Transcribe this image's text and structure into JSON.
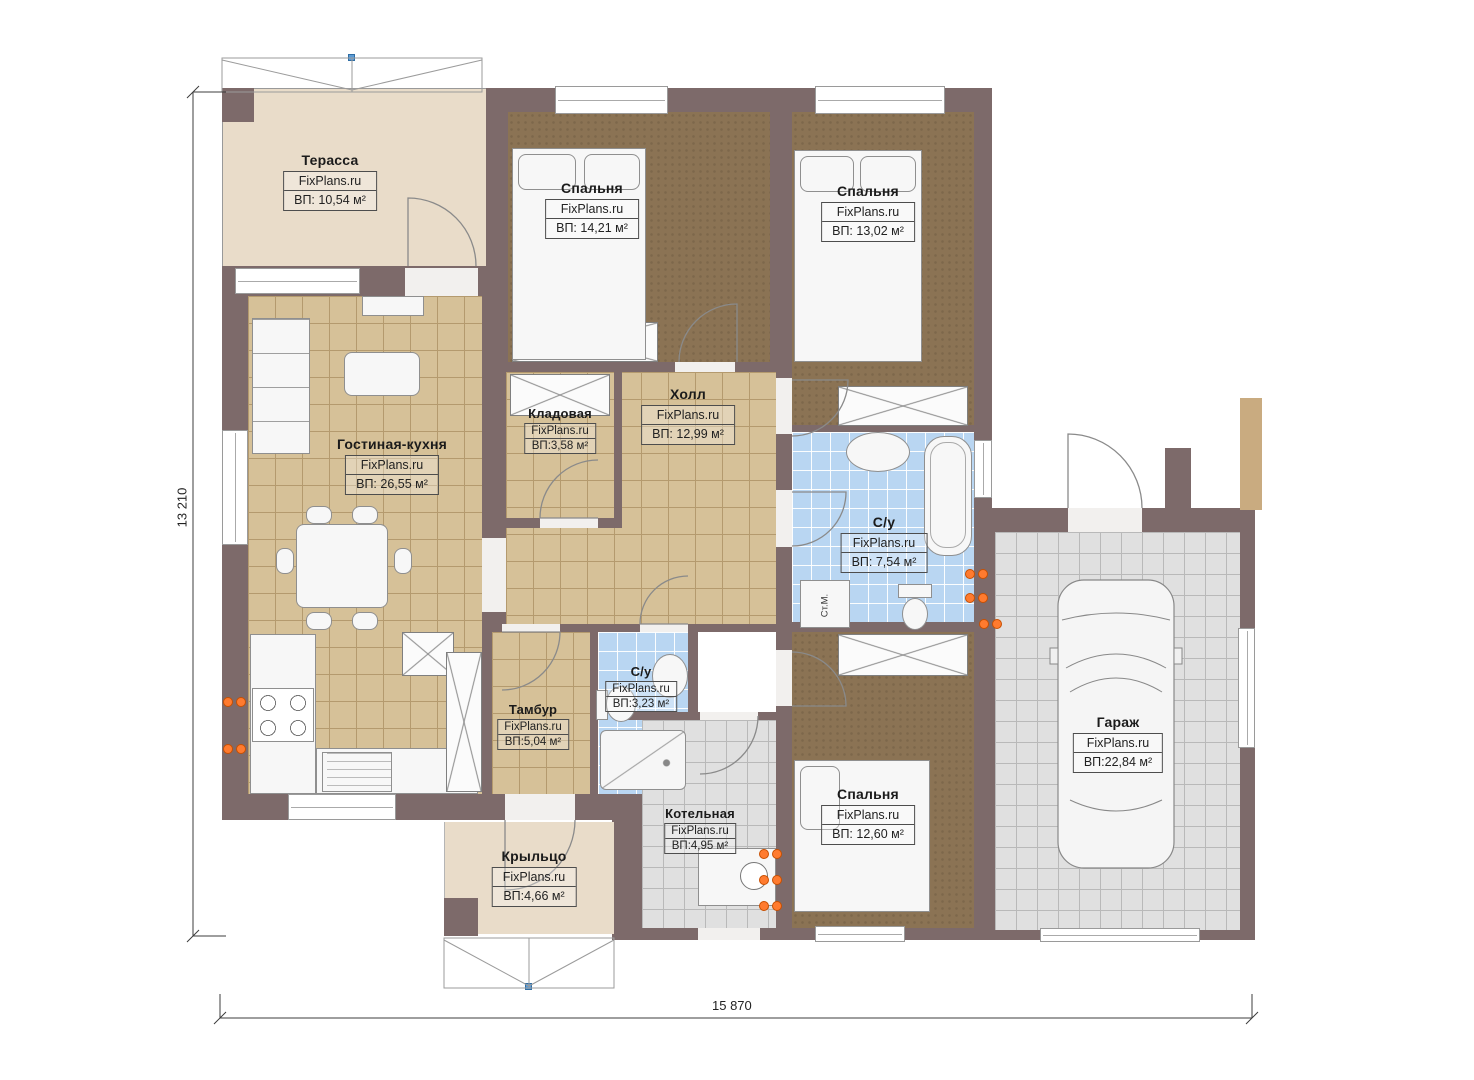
{
  "plan": {
    "site_brand": "FixPlans.ru",
    "dimensions": {
      "width_label": "15 870",
      "height_label": "13 210"
    },
    "labels": {
      "washing_machine": "Ст.М."
    },
    "colors": {
      "wall": "#7d6a6a",
      "tile_tan": "#d6c198",
      "carpet_brown": "#8b7354",
      "tile_blue": "#b9d6f2",
      "tile_gray": "#e0e0e0",
      "outdoor_beige": "#e9dcc9",
      "radiator_orange": "#ff7b2f",
      "roof_marker_blue": "#5b9bd5"
    },
    "rooms": [
      {
        "id": "terrace",
        "name": "Терасса",
        "brand": "FixPlans.ru",
        "area": "ВП: 10,54 м²"
      },
      {
        "id": "bedroom1",
        "name": "Спальня",
        "brand": "FixPlans.ru",
        "area": "ВП: 14,21 м²"
      },
      {
        "id": "bedroom2",
        "name": "Спальня",
        "brand": "FixPlans.ru",
        "area": "ВП: 13,02 м²"
      },
      {
        "id": "living",
        "name": "Гостиная-кухня",
        "brand": "FixPlans.ru",
        "area": "ВП: 26,55 м²"
      },
      {
        "id": "storage",
        "name": "Кладовая",
        "brand": "FixPlans.ru",
        "area": "ВП:3,58 м²"
      },
      {
        "id": "hall",
        "name": "Холл",
        "brand": "FixPlans.ru",
        "area": "ВП: 12,99 м²"
      },
      {
        "id": "bath1",
        "name": "С/у",
        "brand": "FixPlans.ru",
        "area": "ВП: 7,54 м²"
      },
      {
        "id": "tambour",
        "name": "Тамбур",
        "brand": "FixPlans.ru",
        "area": "ВП:5,04 м²"
      },
      {
        "id": "bath2",
        "name": "С/у",
        "brand": "FixPlans.ru",
        "area": "ВП:3,23 м²"
      },
      {
        "id": "boiler",
        "name": "Котельная",
        "brand": "FixPlans.ru",
        "area": "ВП:4,95 м²"
      },
      {
        "id": "bedroom3",
        "name": "Спальня",
        "brand": "FixPlans.ru",
        "area": "ВП: 12,60 м²"
      },
      {
        "id": "garage",
        "name": "Гараж",
        "brand": "FixPlans.ru",
        "area": "ВП:22,84 м²"
      },
      {
        "id": "porch",
        "name": "Крыльцо",
        "brand": "FixPlans.ru",
        "area": "ВП:4,66 м²"
      }
    ]
  }
}
